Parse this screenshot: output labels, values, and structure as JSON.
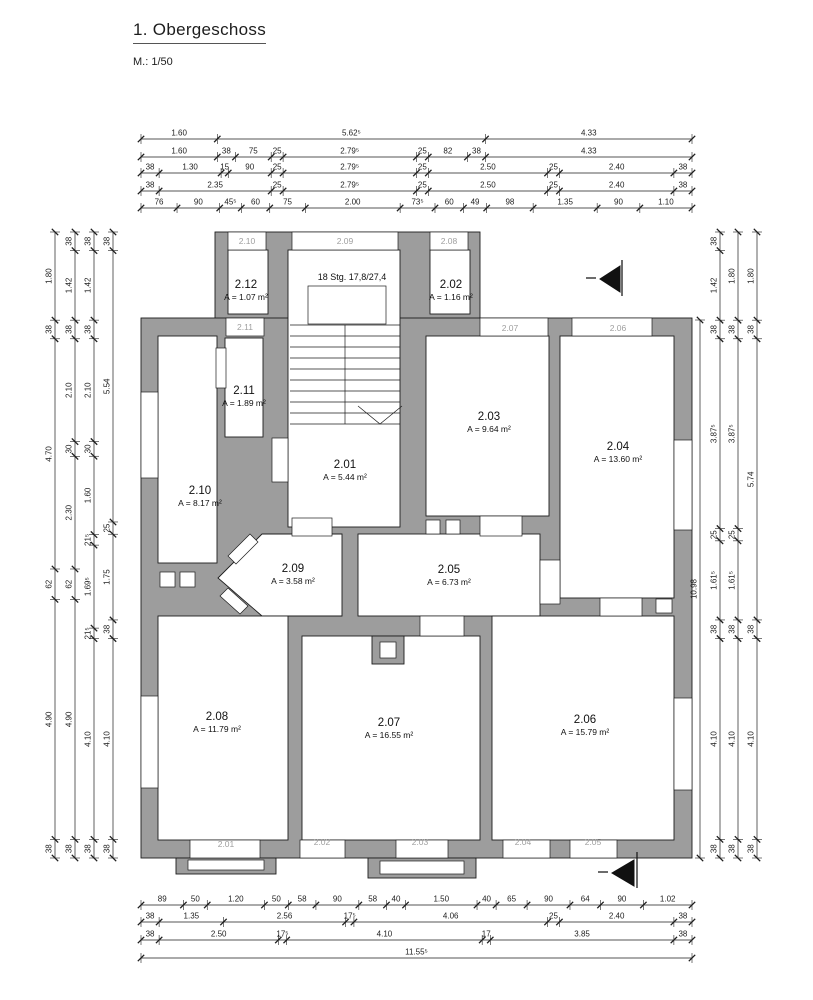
{
  "meta": {
    "title": "1. Obergeschoss",
    "scale": "M.: 1/50"
  },
  "colors": {
    "wall": "#9d9d9d",
    "line": "#1d1d1d",
    "window_tag": "#9f9f9f",
    "background": "#ffffff"
  },
  "stair": {
    "note": "18 Stg. 17,8/27,4",
    "x": 352,
    "y": 280
  },
  "rooms": [
    {
      "id": "2.01",
      "area": "A = 5.44 m²",
      "x": 345,
      "y": 468
    },
    {
      "id": "2.02",
      "area": "A = 1.16 m²",
      "x": 451,
      "y": 288
    },
    {
      "id": "2.03",
      "area": "A = 9.64 m²",
      "x": 489,
      "y": 420
    },
    {
      "id": "2.04",
      "area": "A = 13.60 m²",
      "x": 618,
      "y": 450
    },
    {
      "id": "2.05",
      "area": "A = 6.73 m²",
      "x": 449,
      "y": 573
    },
    {
      "id": "2.06",
      "area": "A = 15.79 m²",
      "x": 585,
      "y": 723
    },
    {
      "id": "2.07",
      "area": "A = 16.55 m²",
      "x": 389,
      "y": 726
    },
    {
      "id": "2.08",
      "area": "A = 11.79 m²",
      "x": 217,
      "y": 720
    },
    {
      "id": "2.09",
      "area": "A = 3.58 m²",
      "x": 293,
      "y": 572
    },
    {
      "id": "2.10",
      "area": "A = 8.17 m²",
      "x": 200,
      "y": 494
    },
    {
      "id": "2.11",
      "area": "A = 1.89 m²",
      "x": 244,
      "y": 394
    },
    {
      "id": "2.12",
      "area": "A = 1.07 m²",
      "x": 246,
      "y": 288
    }
  ],
  "window_tags": [
    {
      "t": "2.10",
      "x": 247,
      "y": 244
    },
    {
      "t": "2.09",
      "x": 345,
      "y": 244
    },
    {
      "t": "2.08",
      "x": 449,
      "y": 244
    },
    {
      "t": "2.11",
      "x": 245,
      "y": 330
    },
    {
      "t": "2.07",
      "x": 510,
      "y": 331
    },
    {
      "t": "2.06",
      "x": 618,
      "y": 331
    },
    {
      "t": "2.01",
      "x": 226,
      "y": 847
    },
    {
      "t": "2.02",
      "x": 322,
      "y": 845
    },
    {
      "t": "2.03",
      "x": 420,
      "y": 845
    },
    {
      "t": "2.04",
      "x": 523,
      "y": 845
    },
    {
      "t": "2.05",
      "x": 593,
      "y": 845
    }
  ],
  "dims": {
    "top": [
      {
        "y": 139,
        "x1": 141,
        "x2": 692,
        "labels": [
          "1.60",
          "5.62⁵",
          "4.33"
        ]
      },
      {
        "y": 157,
        "x1": 141,
        "x2": 692,
        "labels": [
          "1.60",
          "38",
          "75",
          "25",
          "2.79⁵",
          "25",
          "82",
          "38",
          "4.33"
        ]
      },
      {
        "y": 173,
        "x1": 141,
        "x2": 692,
        "labels": [
          "38",
          "1.30",
          "15",
          "90",
          "25",
          "2.79⁵",
          "25",
          "2.50",
          "25",
          "2.40",
          "38"
        ]
      },
      {
        "y": 191,
        "x1": 141,
        "x2": 692,
        "labels": [
          "38",
          "2.35",
          "25",
          "2.79⁵",
          "25",
          "2.50",
          "25",
          "2.40",
          "38"
        ]
      },
      {
        "y": 208,
        "x1": 141,
        "x2": 692,
        "labels": [
          "76",
          "90",
          "45⁵",
          "60",
          "75",
          "2.00",
          "73⁵",
          "60",
          "49",
          "98",
          "1.35",
          "90",
          "1.10"
        ]
      }
    ],
    "bottom": [
      {
        "y": 905,
        "x1": 141,
        "x2": 692,
        "labels": [
          "89",
          "50",
          "1.20",
          "50",
          "58",
          "90",
          "58",
          "40",
          "1.50",
          "40",
          "65",
          "90",
          "64",
          "90",
          "1.02"
        ]
      },
      {
        "y": 922,
        "x1": 141,
        "x2": 692,
        "labels": [
          "38",
          "1.35",
          "2.56",
          "17⁵",
          "4.06",
          "25",
          "2.40",
          "38"
        ]
      },
      {
        "y": 940,
        "x1": 141,
        "x2": 692,
        "labels": [
          "38",
          "2.50",
          "17⁵",
          "4.10",
          "17",
          "3.85",
          "38"
        ]
      },
      {
        "y": 958,
        "x1": 141,
        "x2": 692,
        "labels": [
          "11.55⁵"
        ]
      }
    ],
    "left": [
      {
        "x": 55,
        "y1": 232,
        "y2": 858,
        "labels": [
          "1.80",
          "38",
          "4.70",
          "62",
          "4.90",
          "38"
        ]
      },
      {
        "x": 75,
        "y1": 232,
        "y2": 858,
        "labels": [
          "38",
          "1.42",
          "38",
          "2.10",
          "30",
          "2.30",
          "62",
          "4.90",
          "38"
        ]
      },
      {
        "x": 94,
        "y1": 232,
        "y2": 858,
        "labels": [
          "38",
          "1.42",
          "38",
          "2.10",
          "30",
          "1.60",
          "21⁵",
          "1.69⁵",
          "21⁵",
          "4.10",
          "38"
        ]
      },
      {
        "x": 113,
        "y1": 232,
        "y2": 858,
        "labels": [
          "38",
          "5.54",
          "25",
          "1.75",
          "38",
          "4.10",
          "38"
        ]
      }
    ],
    "right": [
      {
        "x": 700,
        "y1": 320,
        "y2": 858,
        "labels": [
          "10.98"
        ]
      },
      {
        "x": 720,
        "y1": 232,
        "y2": 858,
        "labels": [
          "38",
          "1.42",
          "38",
          "3.87⁵",
          "25",
          "1.61⁵",
          "38",
          "4.10",
          "38"
        ]
      },
      {
        "x": 738,
        "y1": 232,
        "y2": 858,
        "labels": [
          "1.80",
          "38",
          "3.87⁵",
          "25",
          "1.61⁵",
          "38",
          "4.10",
          "38"
        ]
      },
      {
        "x": 757,
        "y1": 232,
        "y2": 858,
        "labels": [
          "1.80",
          "38",
          "5.74",
          "38",
          "4.10",
          "38"
        ]
      }
    ]
  }
}
